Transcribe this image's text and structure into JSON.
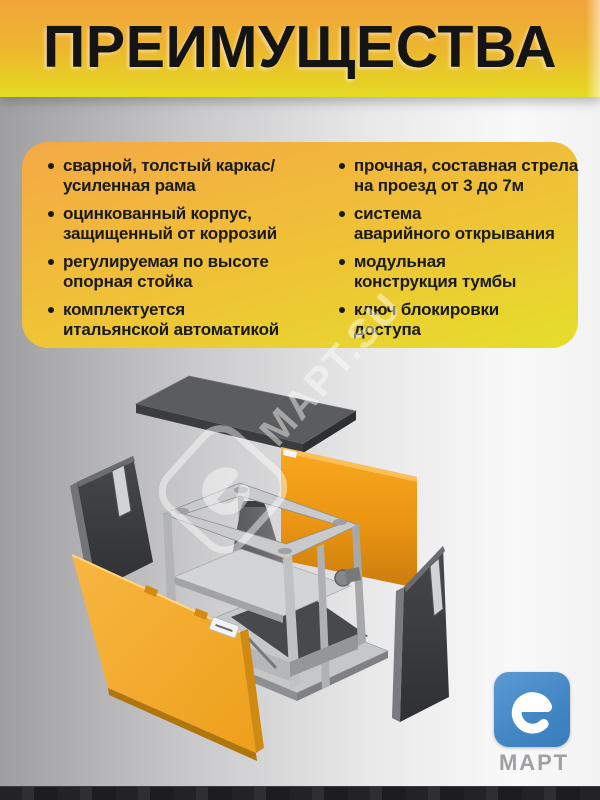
{
  "header": {
    "title": "ПРЕИМУЩЕСТВА"
  },
  "advantages": {
    "left": [
      {
        "line1": "сварной, толстый каркас/",
        "line2": "усиленная рама"
      },
      {
        "line1": "оцинкованный корпус,",
        "line2": "защищенный от коррозий"
      },
      {
        "line1": "регулируемая по высоте",
        "line2": "опорная стойка"
      },
      {
        "line1": "комплектуется",
        "line2": "итальянской автоматикой"
      }
    ],
    "right": [
      {
        "line1": "прочная, составная стрела",
        "line2": "на проезд от 3 до 7м"
      },
      {
        "line1": "система",
        "line2": "аварийного открывания"
      },
      {
        "line1": "модульная",
        "line2": "конструкция тумбы"
      },
      {
        "line1": "ключ блокировки",
        "line2": "доступа"
      }
    ]
  },
  "watermark": {
    "letter": "е",
    "text": "МАРТ.SU"
  },
  "logo": {
    "letter": "е",
    "text": "МАРТ"
  },
  "diagram": {
    "type": "exploded-view",
    "subject": "barrier cabinet (тумба шлагбаума)",
    "parts": [
      "top lid panel",
      "rear orange panel",
      "steel frame with drive unit",
      "left side panel",
      "front orange panel",
      "right side panel"
    ]
  },
  "colors": {
    "header_top": "#f2a43c",
    "header_bottom": "#e5da22",
    "card_top": "#f4a945",
    "card_bottom": "#e5de2b",
    "panel_orange": "#efa31d",
    "dark_panel": "#3c3d3f",
    "metal_gray": "#c9cacc",
    "logo_blue": "#4286c4",
    "text_dark": "#1a1a1a",
    "watermark_white": "#ffffff"
  }
}
